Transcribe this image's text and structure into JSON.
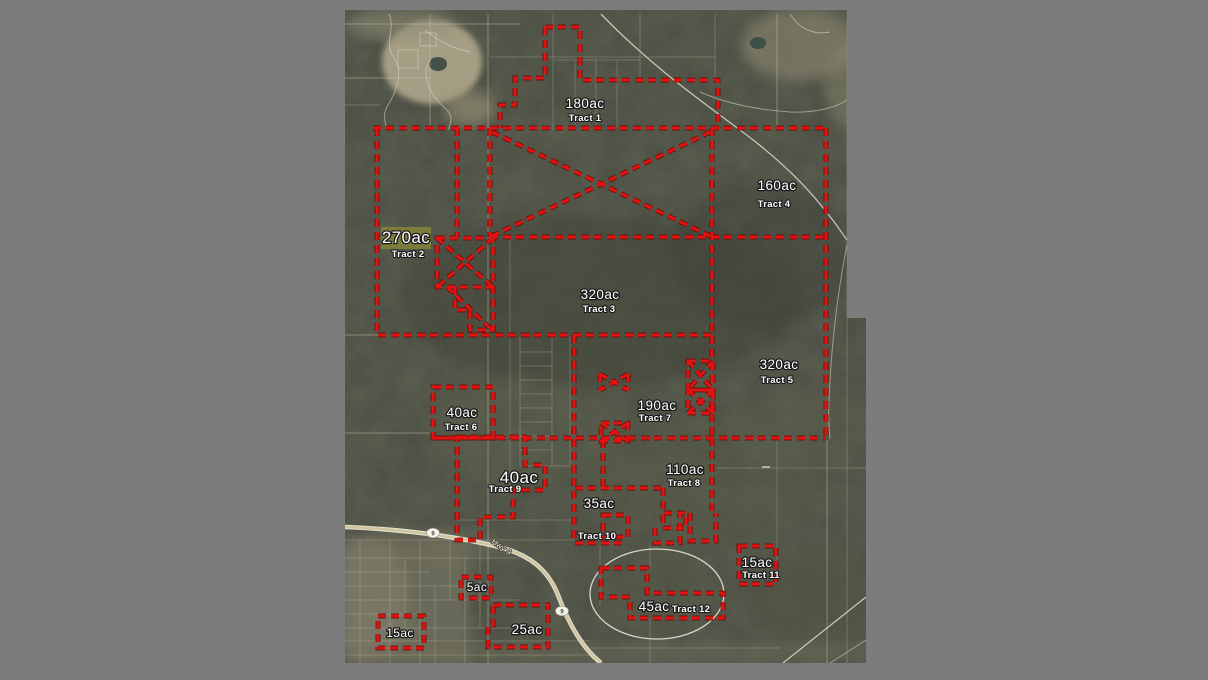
{
  "canvas": {
    "background": "#7c7c7c"
  },
  "map": {
    "boundary_color": "#e31212",
    "highlight_color": "#7f7e3a",
    "tracts": [
      {
        "acreage": "180ac",
        "name": "Tract 1"
      },
      {
        "acreage": "270ac",
        "name": "Tract 2"
      },
      {
        "acreage": "320ac",
        "name": "Tract 3"
      },
      {
        "acreage": "160ac",
        "name": "Tract 4"
      },
      {
        "acreage": "320ac",
        "name": "Tract 5"
      },
      {
        "acreage": "40ac",
        "name": "Tract 6"
      },
      {
        "acreage": "190ac",
        "name": "Tract 7"
      },
      {
        "acreage": "110ac",
        "name": "Tract 8"
      },
      {
        "acreage": "40ac",
        "name": "Tract 9"
      },
      {
        "acreage": "35ac",
        "name": "Tract 10"
      },
      {
        "acreage": "15ac",
        "name": "Tract 11"
      },
      {
        "acreage": "45ac",
        "name": "Tract 12"
      }
    ],
    "parcels": [
      {
        "acreage": "5ac"
      },
      {
        "acreage": "25ac"
      },
      {
        "acreage": "15ac"
      }
    ],
    "roads": {
      "highway_label": "Hwy 9",
      "route_shield": "9"
    }
  }
}
